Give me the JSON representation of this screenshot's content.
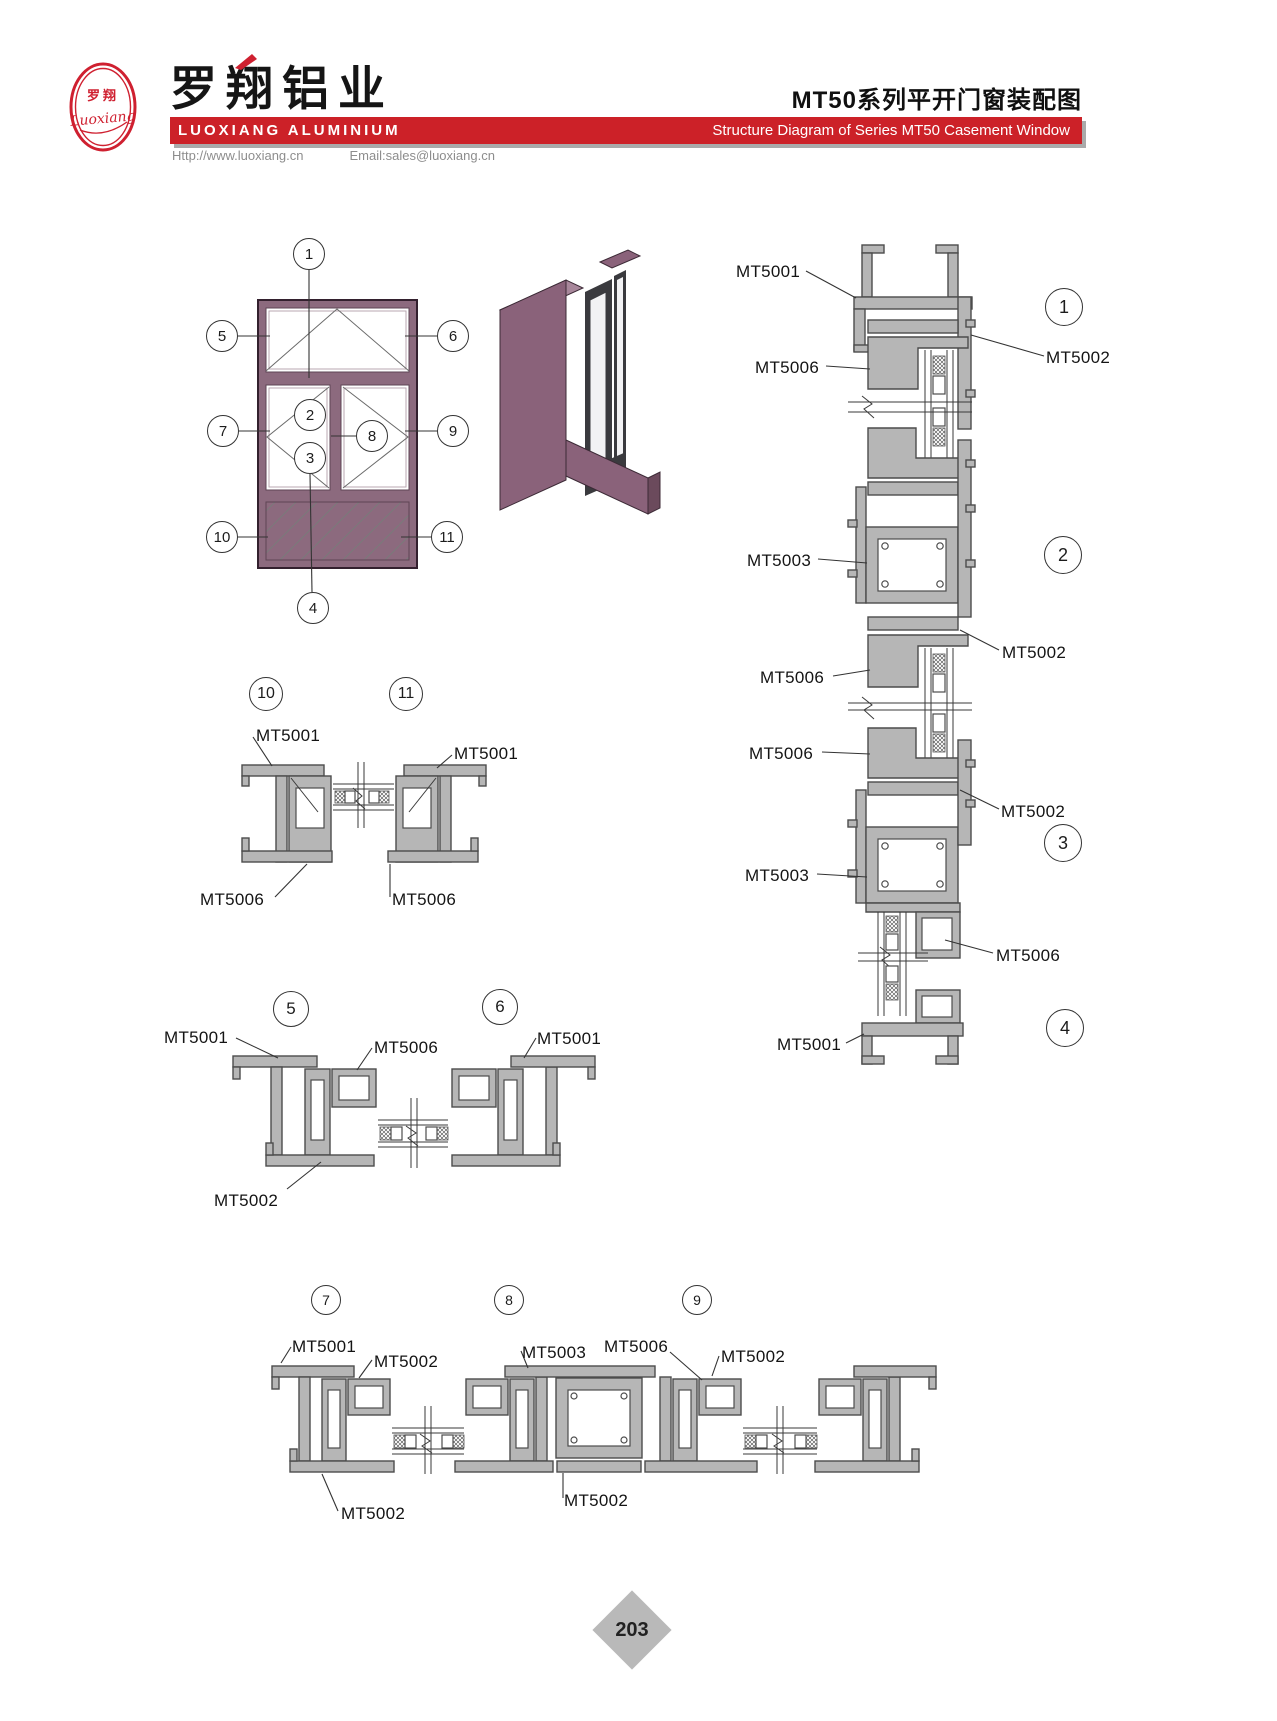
{
  "header": {
    "logo": {
      "cn": "罗翔",
      "script": "Luoxiang"
    },
    "company_cn": "罗翔铝业",
    "company_en": "LUOXIANG ALUMINIUM",
    "website": "Http://www.luoxiang.cn",
    "email": "Email:sales@luoxiang.cn",
    "title_cn": "MT50系列平开门窗装配图",
    "title_en": "Structure Diagram of Series MT50 Casement Window",
    "brand_red": "#cc2128"
  },
  "elevation": {
    "callouts": [
      {
        "n": "1",
        "cx": 309,
        "cy": 254,
        "r": 16
      },
      {
        "n": "5",
        "cx": 222,
        "cy": 336,
        "r": 16
      },
      {
        "n": "6",
        "cx": 453,
        "cy": 336,
        "r": 16
      },
      {
        "n": "2",
        "cx": 310,
        "cy": 415,
        "r": 16
      },
      {
        "n": "3",
        "cx": 310,
        "cy": 458,
        "r": 16
      },
      {
        "n": "7",
        "cx": 223,
        "cy": 431,
        "r": 16
      },
      {
        "n": "8",
        "cx": 372,
        "cy": 436,
        "r": 16
      },
      {
        "n": "9",
        "cx": 453,
        "cy": 431,
        "r": 16
      },
      {
        "n": "10",
        "cx": 222,
        "cy": 537,
        "r": 16
      },
      {
        "n": "11",
        "cx": 447,
        "cy": 537,
        "r": 16
      },
      {
        "n": "4",
        "cx": 313,
        "cy": 608,
        "r": 16
      }
    ],
    "labels": []
  },
  "details": {
    "right_column": {
      "callouts": [
        {
          "n": "1",
          "cx": 1064,
          "cy": 307,
          "r": 19
        },
        {
          "n": "2",
          "cx": 1063,
          "cy": 555,
          "r": 19
        },
        {
          "n": "3",
          "cx": 1063,
          "cy": 843,
          "r": 19
        },
        {
          "n": "4",
          "cx": 1065,
          "cy": 1028,
          "r": 19
        }
      ],
      "labels": [
        {
          "text": "MT5001",
          "x": 736,
          "y": 262
        },
        {
          "text": "MT5006",
          "x": 755,
          "y": 358
        },
        {
          "text": "MT5002",
          "x": 1046,
          "y": 348
        },
        {
          "text": "MT5003",
          "x": 747,
          "y": 551
        },
        {
          "text": "MT5002",
          "x": 1002,
          "y": 643
        },
        {
          "text": "MT5006",
          "x": 760,
          "y": 668
        },
        {
          "text": "MT5006",
          "x": 749,
          "y": 744
        },
        {
          "text": "MT5002",
          "x": 1001,
          "y": 802
        },
        {
          "text": "MT5003",
          "x": 745,
          "y": 866
        },
        {
          "text": "MT5006",
          "x": 996,
          "y": 946
        },
        {
          "text": "MT5001",
          "x": 777,
          "y": 1035
        }
      ]
    },
    "pair_10_11": {
      "callouts": [
        {
          "n": "10",
          "cx": 266,
          "cy": 694,
          "r": 17
        },
        {
          "n": "11",
          "cx": 406,
          "cy": 694,
          "r": 17
        }
      ],
      "labels": [
        {
          "text": "MT5001",
          "x": 256,
          "y": 726
        },
        {
          "text": "MT5001",
          "x": 454,
          "y": 744
        },
        {
          "text": "MT5006",
          "x": 200,
          "y": 890
        },
        {
          "text": "MT5006",
          "x": 392,
          "y": 890
        }
      ]
    },
    "pair_5_6": {
      "callouts": [
        {
          "n": "5",
          "cx": 291,
          "cy": 1009,
          "r": 18
        },
        {
          "n": "6",
          "cx": 500,
          "cy": 1007,
          "r": 18
        }
      ],
      "labels": [
        {
          "text": "MT5001",
          "x": 164,
          "y": 1028
        },
        {
          "text": "MT5006",
          "x": 374,
          "y": 1038
        },
        {
          "text": "MT5001",
          "x": 537,
          "y": 1029
        },
        {
          "text": "MT5002",
          "x": 214,
          "y": 1191
        }
      ]
    },
    "trio_7_8_9": {
      "callouts": [
        {
          "n": "7",
          "cx": 326,
          "cy": 1300,
          "r": 15
        },
        {
          "n": "8",
          "cx": 509,
          "cy": 1300,
          "r": 15
        },
        {
          "n": "9",
          "cx": 697,
          "cy": 1300,
          "r": 15
        }
      ],
      "labels": [
        {
          "text": "MT5001",
          "x": 292,
          "y": 1337
        },
        {
          "text": "MT5002",
          "x": 374,
          "y": 1352
        },
        {
          "text": "MT5003",
          "x": 522,
          "y": 1343
        },
        {
          "text": "MT5006",
          "x": 604,
          "y": 1337
        },
        {
          "text": "MT5002",
          "x": 721,
          "y": 1347
        },
        {
          "text": "MT5002",
          "x": 341,
          "y": 1504
        },
        {
          "text": "MT5002",
          "x": 564,
          "y": 1491
        }
      ]
    }
  },
  "footer": {
    "page_number": "203"
  }
}
